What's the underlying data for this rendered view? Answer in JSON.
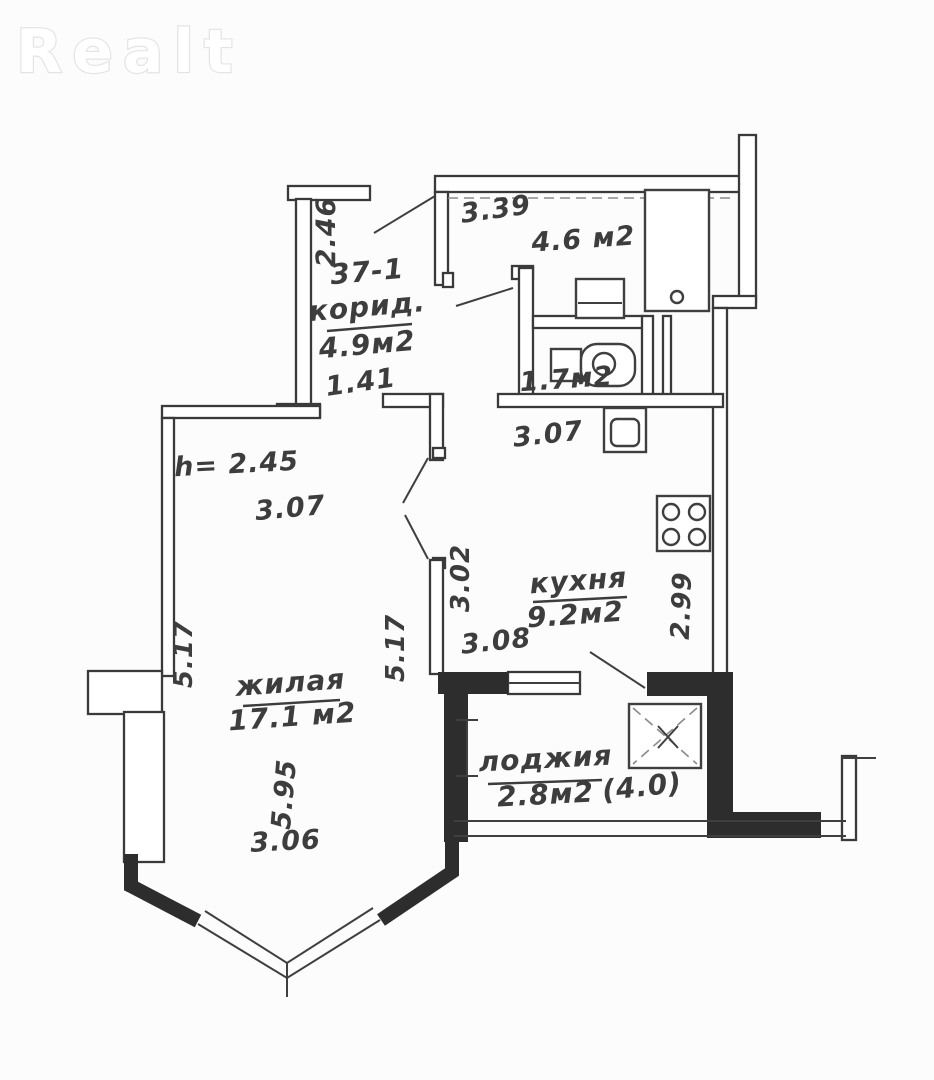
{
  "watermark": "Realt",
  "plan": {
    "apartment_number": "37-1",
    "ceiling_height": "h= 2.45",
    "rooms": {
      "corridor": {
        "name": "корид.",
        "area": "4.9м2"
      },
      "top_room": {
        "area": "4.6 м2"
      },
      "bathroom": {
        "area": "1.7м2"
      },
      "kitchen": {
        "name": "кухня",
        "area": "9.2м2"
      },
      "living": {
        "name": "жилая",
        "area": "17.1 м2"
      },
      "loggia": {
        "name": "лоджия",
        "area": "2.8м2",
        "area_alt": "(4.0)"
      }
    },
    "dims": {
      "corridor_height": "2.46",
      "top_width": "3.39",
      "corridor_opening": "1.41",
      "hall_width": "3.07",
      "living_width": "3.07",
      "kitchen_inner": "3.02",
      "kitchen_height": "2.99",
      "kitchen_bottom": "3.08",
      "living_left": "5.17",
      "living_right": "5.17",
      "living_lower": "5.95",
      "bay_width": "3.06"
    },
    "colors": {
      "line": "#3a3a3a",
      "thick_wall": "#2d2d2d",
      "watermark": "#e4e4e4",
      "background": "#fcfcfc"
    }
  }
}
